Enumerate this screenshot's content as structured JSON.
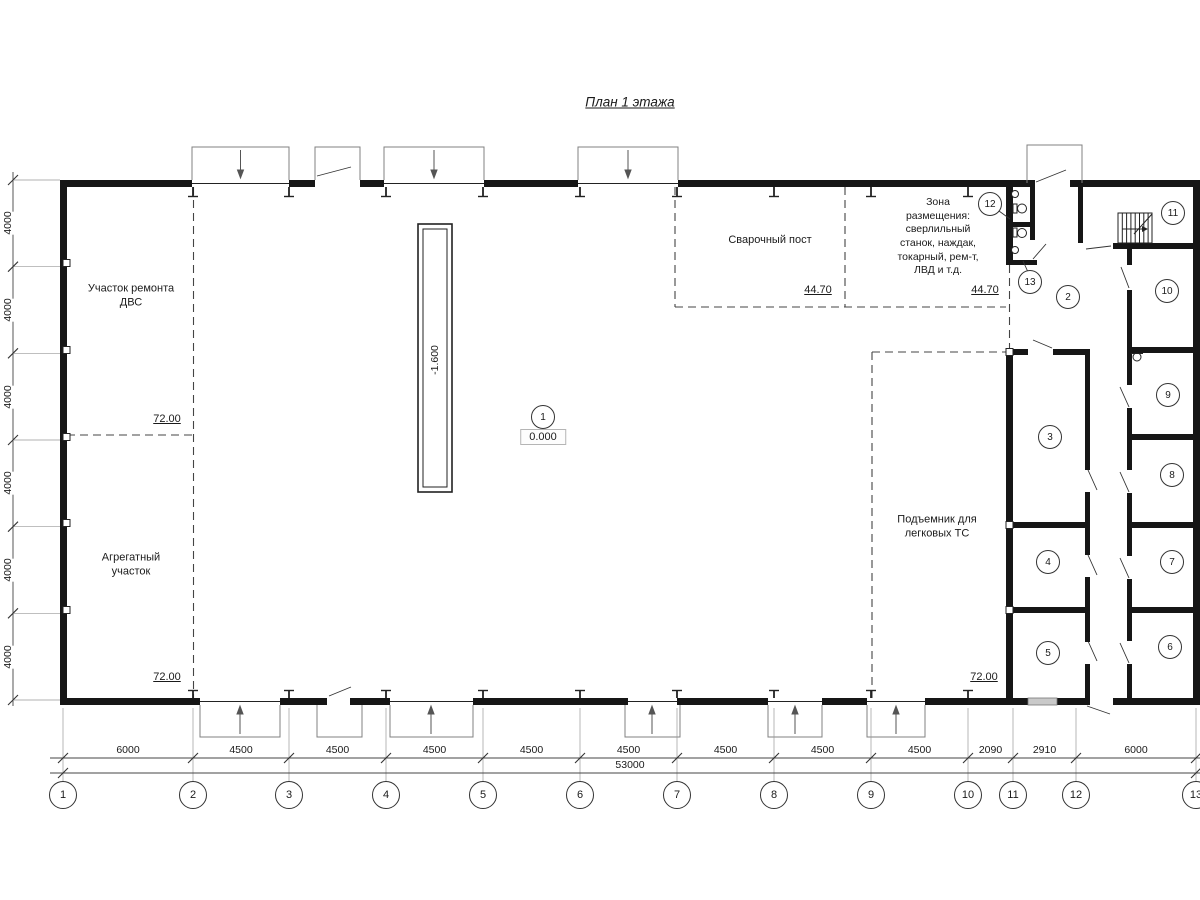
{
  "title": "План 1 этажа",
  "labels": {
    "engine_repair_area": "Участок ремонта\nДВС",
    "assembly_area": "Агрегатный\nучасток",
    "welding_station": "Сварочный пост",
    "equipment_zone": "Зона\nразмещения:\nсверлильный\nстанок, наждак,\nтокарный, рем-т,\nЛВД и т.д.",
    "car_lift": "Подъемник для\nлегковых ТС"
  },
  "elevations": {
    "engine_area": "72.00",
    "assembly_area": "72.00",
    "welding_left": "44.70",
    "welding_right": "44.70",
    "lift_area": "72.00",
    "pit_depth": "-1.600",
    "floor_level": "0.000"
  },
  "room_numbers": [
    "1",
    "2",
    "3",
    "4",
    "5",
    "6",
    "7",
    "8",
    "9",
    "10",
    "11",
    "12",
    "13"
  ],
  "column_axes": [
    "1",
    "2",
    "3",
    "4",
    "5",
    "6",
    "7",
    "8",
    "9",
    "10",
    "11",
    "12",
    "13"
  ],
  "dimensions": {
    "bottom_segments": [
      "6000",
      "4500",
      "4500",
      "4500",
      "4500",
      "4500",
      "4500",
      "4500",
      "4500",
      "2090",
      "2910",
      "6000"
    ],
    "bottom_total": "53000",
    "left_segments": [
      "4000",
      "4000",
      "4000",
      "4000",
      "4000",
      "4000"
    ]
  }
}
